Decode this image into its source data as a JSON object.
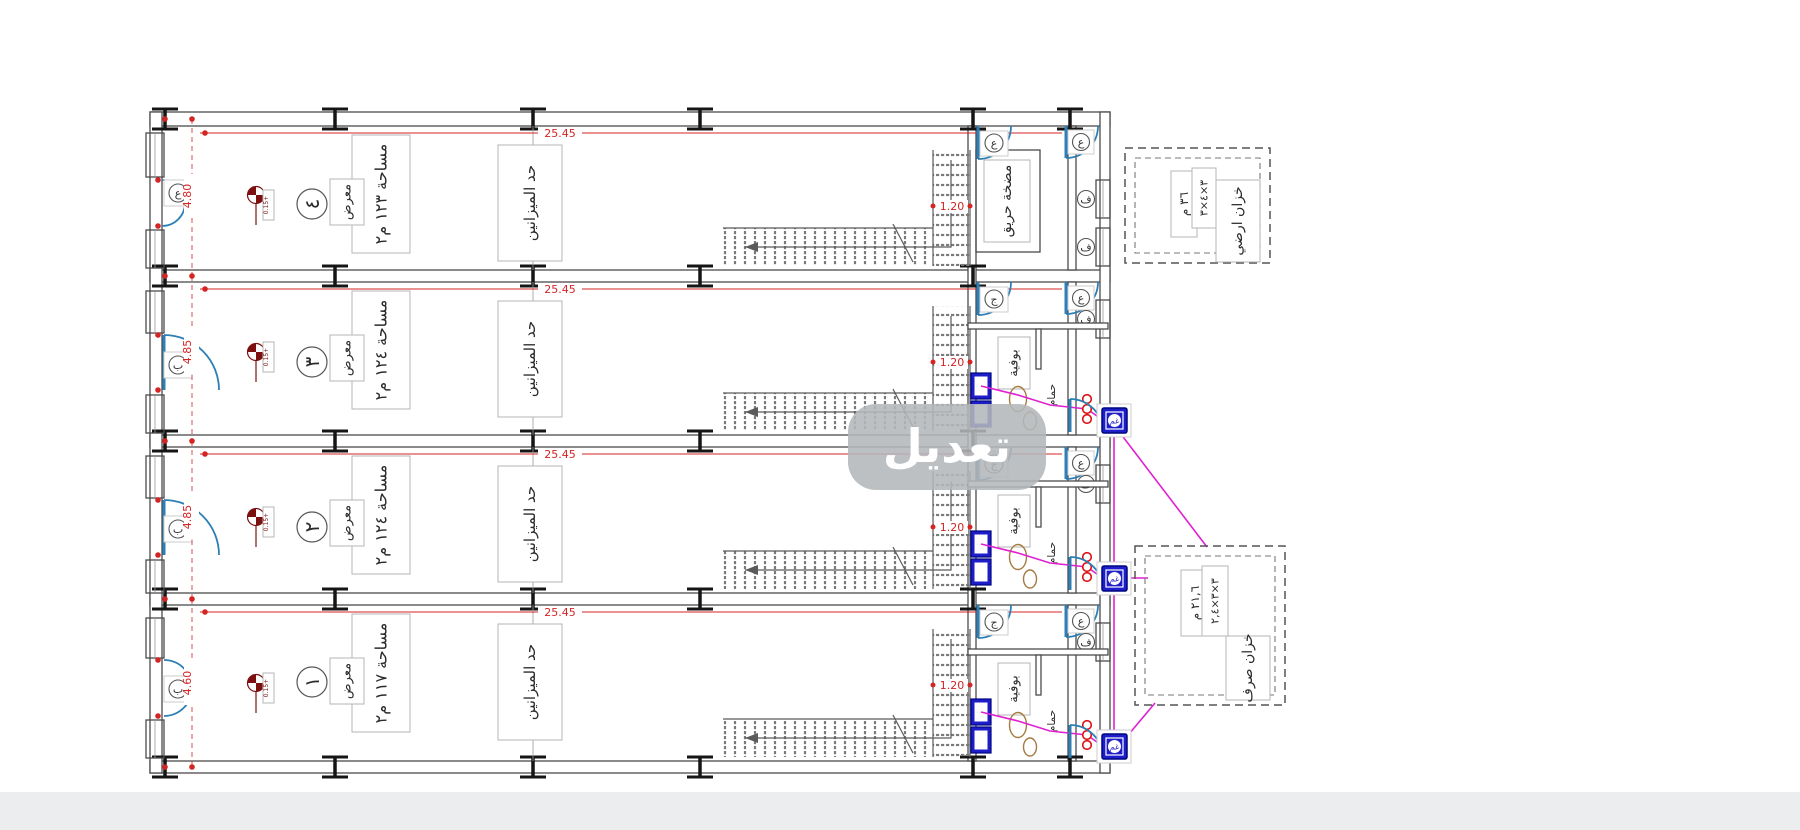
{
  "watermark": "تعديل",
  "labels": {
    "mezzanine": "حد الميزانين",
    "use": "معرض",
    "buffet": "بوفية",
    "bath": "حمام",
    "pump_room": "مضخة حريق",
    "level_mark": "0.15+"
  },
  "tags": {
    "door_top": "ع",
    "door_left": "ب",
    "door_inner": "ج",
    "window": "ف",
    "manhole": "غم"
  },
  "dims": {
    "length": "25.45",
    "stair": "1.20"
  },
  "units": [
    {
      "id": "4",
      "number": "٤",
      "area": "مساحة ١٢٣ م٢",
      "width": "4.80"
    },
    {
      "id": "3",
      "number": "٣",
      "area": "مساحة ١٢٤ م٢",
      "width": "4.85"
    },
    {
      "id": "2",
      "number": "٢",
      "area": "مساحة ١٢٤ م٢",
      "width": "4.85"
    },
    {
      "id": "1",
      "number": "١",
      "area": "مساحة ١١٧ م٢",
      "width": "4.60"
    }
  ],
  "tanks": {
    "ground": {
      "name": "خزان ارضي",
      "dims": "٣×٤×٣",
      "volume": "٣٦ م"
    },
    "sewage": {
      "name": "خزان صرف",
      "dims": "٣×٣×٢,٤",
      "volume": "٢١,٦ م"
    }
  },
  "colors": {
    "dimension_red": "#d42424",
    "door_blue": "#2d7fb5",
    "fixture_blue": "#1d1dc9",
    "pipe_magenta": "#e020d0",
    "wall_gray": "#4b4b4b",
    "watermark_gray": "#b4b7ba"
  }
}
